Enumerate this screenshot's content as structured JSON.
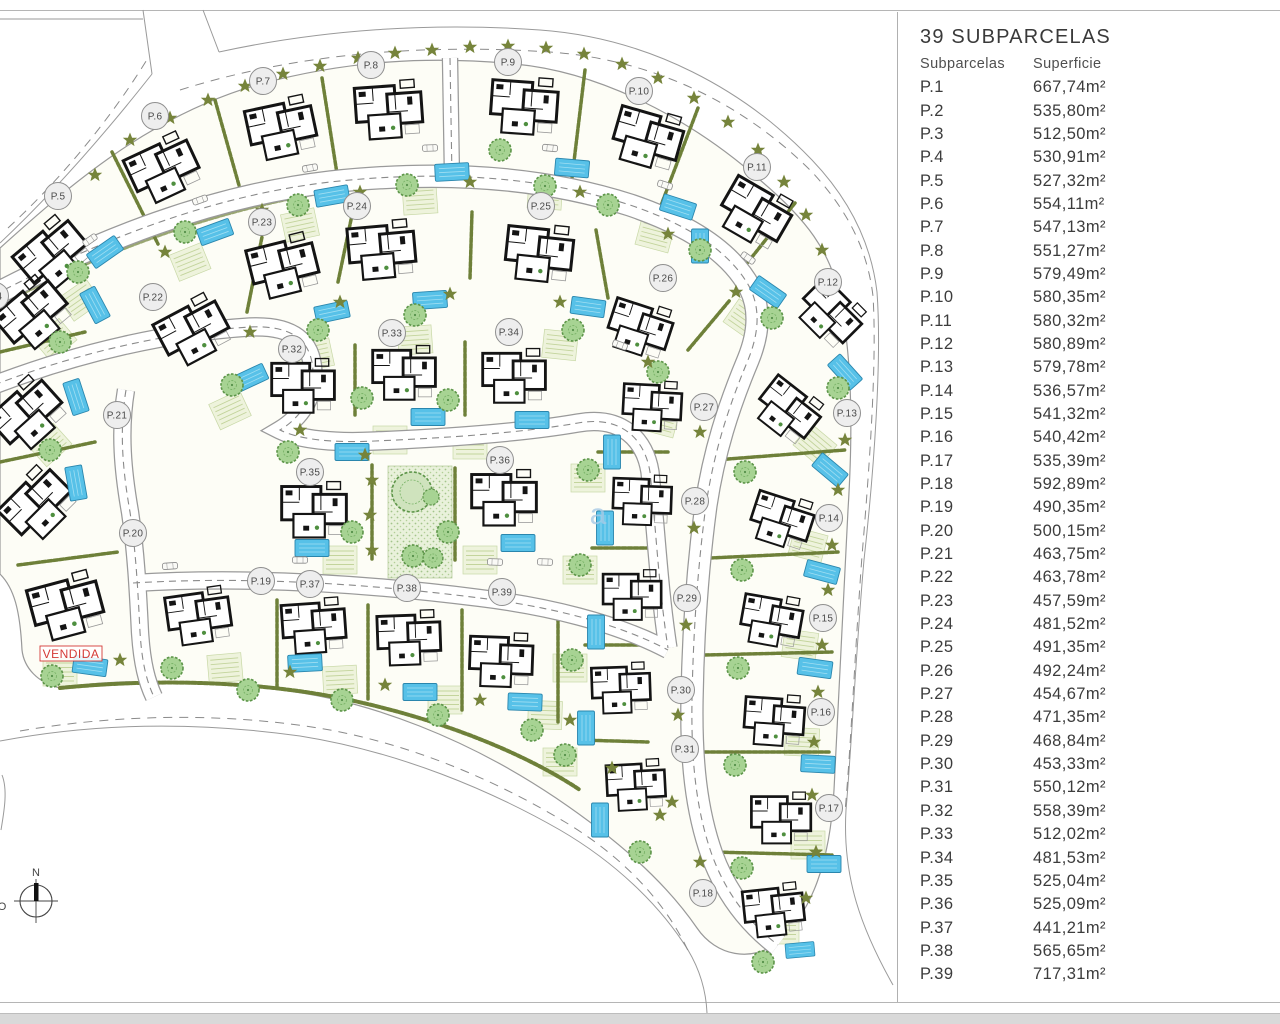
{
  "panel": {
    "title": "39 SUBPARCELAS",
    "col_parcel": "Subparcelas",
    "col_area": "Superficie",
    "rows": [
      {
        "p": "P.1",
        "s": "667,74m²"
      },
      {
        "p": "P.2",
        "s": "535,80m²"
      },
      {
        "p": "P.3",
        "s": "512,50m²"
      },
      {
        "p": "P.4",
        "s": "530,91m²"
      },
      {
        "p": "P.5",
        "s": "527,32m²"
      },
      {
        "p": "P.6",
        "s": "554,11m²"
      },
      {
        "p": "P.7",
        "s": "547,13m²"
      },
      {
        "p": "P.8",
        "s": "551,27m²"
      },
      {
        "p": "P.9",
        "s": "579,49m²"
      },
      {
        "p": "P.10",
        "s": "580,35m²"
      },
      {
        "p": "P.11",
        "s": "580,32m²"
      },
      {
        "p": "P.12",
        "s": "580,89m²"
      },
      {
        "p": "P.13",
        "s": "579,78m²"
      },
      {
        "p": "P.14",
        "s": "536,57m²"
      },
      {
        "p": "P.15",
        "s": "541,32m²"
      },
      {
        "p": "P.16",
        "s": "540,42m²"
      },
      {
        "p": "P.17",
        "s": "535,39m²"
      },
      {
        "p": "P.18",
        "s": "592,89m²"
      },
      {
        "p": "P.19",
        "s": "490,35m²"
      },
      {
        "p": "P.20",
        "s": "500,15m²"
      },
      {
        "p": "P.21",
        "s": "463,75m²"
      },
      {
        "p": "P.22",
        "s": "463,78m²"
      },
      {
        "p": "P.23",
        "s": "457,59m²"
      },
      {
        "p": "P.24",
        "s": "481,52m²"
      },
      {
        "p": "P.25",
        "s": "491,35m²"
      },
      {
        "p": "P.26",
        "s": "492,24m²"
      },
      {
        "p": "P.27",
        "s": "454,67m²"
      },
      {
        "p": "P.28",
        "s": "471,35m²"
      },
      {
        "p": "P.29",
        "s": "468,84m²"
      },
      {
        "p": "P.30",
        "s": "453,33m²"
      },
      {
        "p": "P.31",
        "s": "550,12m²"
      },
      {
        "p": "P.32",
        "s": "558,39m²"
      },
      {
        "p": "P.33",
        "s": "512,02m²"
      },
      {
        "p": "P.34",
        "s": "481,53m²"
      },
      {
        "p": "P.35",
        "s": "525,04m²"
      },
      {
        "p": "P.36",
        "s": "525,09m²"
      },
      {
        "p": "P.37",
        "s": "441,21m²"
      },
      {
        "p": "P.38",
        "s": "565,65m²"
      },
      {
        "p": "P.39",
        "s": "717,31m²"
      }
    ]
  },
  "plan": {
    "sold_label": "VENDIDA",
    "compass_north": "N",
    "compass_west_fragment": "O",
    "watermark": "a",
    "labels": [
      {
        "t": "P.4",
        "x": -5,
        "y": 296
      },
      {
        "t": "P.5",
        "x": 58,
        "y": 196
      },
      {
        "t": "P.6",
        "x": 155,
        "y": 116
      },
      {
        "t": "P.7",
        "x": 263,
        "y": 81
      },
      {
        "t": "P.8",
        "x": 371,
        "y": 65
      },
      {
        "t": "P.9",
        "x": 508,
        "y": 62
      },
      {
        "t": "P.10",
        "x": 639,
        "y": 91
      },
      {
        "t": "P.11",
        "x": 757,
        "y": 167
      },
      {
        "t": "P.12",
        "x": 828,
        "y": 282
      },
      {
        "t": "P.13",
        "x": 847,
        "y": 413
      },
      {
        "t": "P.14",
        "x": 829,
        "y": 518
      },
      {
        "t": "P.15",
        "x": 823,
        "y": 618
      },
      {
        "t": "P.16",
        "x": 821,
        "y": 712
      },
      {
        "t": "P.17",
        "x": 829,
        "y": 808
      },
      {
        "t": "P.18",
        "x": 703,
        "y": 893
      },
      {
        "t": "P.19",
        "x": 261,
        "y": 581
      },
      {
        "t": "P.20",
        "x": 133,
        "y": 533
      },
      {
        "t": "P.21",
        "x": 117,
        "y": 415
      },
      {
        "t": "P.22",
        "x": 153,
        "y": 297
      },
      {
        "t": "P.23",
        "x": 262,
        "y": 222
      },
      {
        "t": "P.24",
        "x": 357,
        "y": 206
      },
      {
        "t": "P.25",
        "x": 541,
        "y": 206
      },
      {
        "t": "P.26",
        "x": 663,
        "y": 278
      },
      {
        "t": "P.27",
        "x": 704,
        "y": 407
      },
      {
        "t": "P.28",
        "x": 695,
        "y": 501
      },
      {
        "t": "P.29",
        "x": 687,
        "y": 598
      },
      {
        "t": "P.30",
        "x": 681,
        "y": 690
      },
      {
        "t": "P.31",
        "x": 685,
        "y": 749
      },
      {
        "t": "P.32",
        "x": 292,
        "y": 349
      },
      {
        "t": "P.33",
        "x": 392,
        "y": 333
      },
      {
        "t": "P.34",
        "x": 509,
        "y": 332
      },
      {
        "t": "P.35",
        "x": 310,
        "y": 472
      },
      {
        "t": "P.36",
        "x": 500,
        "y": 460
      },
      {
        "t": "P.37",
        "x": 310,
        "y": 584
      },
      {
        "t": "P.38",
        "x": 407,
        "y": 588
      },
      {
        "t": "P.39",
        "x": 502,
        "y": 592
      }
    ]
  },
  "colors": {
    "pool": "#57c1e8",
    "tree": "#a7d393",
    "star": "#76843b",
    "hedge": "#6e8039",
    "sold": "#d43a36",
    "road_edge": "#9a9a9a",
    "panel_text": "#3c3c3c",
    "watermark": "#a9cbe6"
  }
}
